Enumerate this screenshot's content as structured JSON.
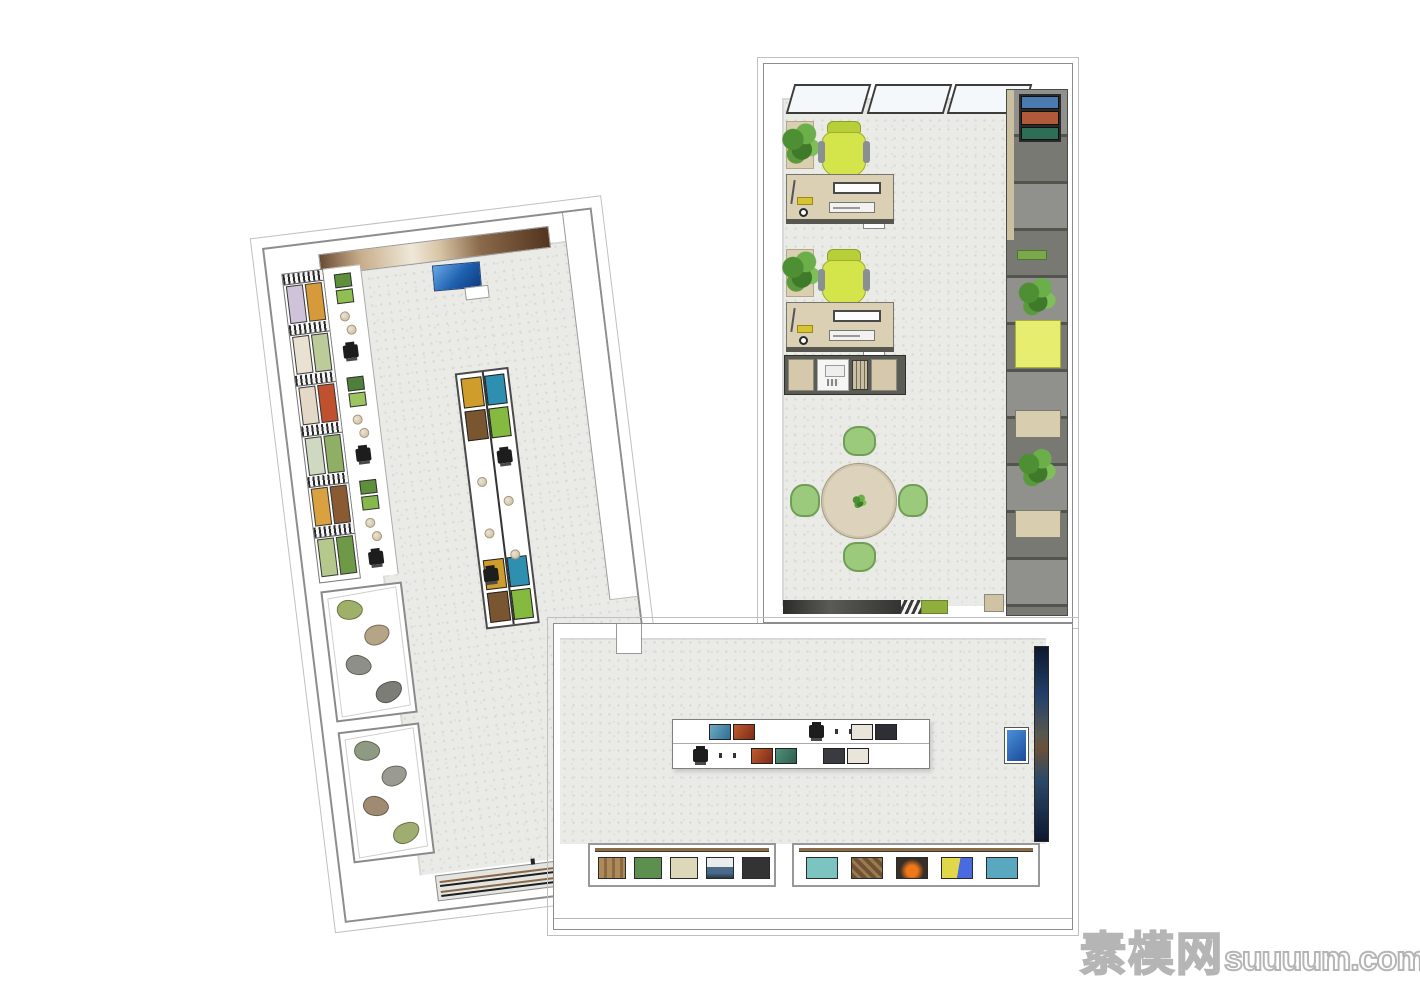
{
  "scene": {
    "type": "3D top-view floor plan render of an L-shaped exhibition hall with office",
    "background": "#ffffff",
    "floor_color": "#eaeae7",
    "wall_color": "#ffffff",
    "outline_color": "#8d8d8d"
  },
  "watermark": {
    "cn": "素模网",
    "en": "suuuum.com",
    "color": "#b5b5b5"
  },
  "left_gallery": {
    "mural_style": "background:linear-gradient(90deg,#6b4c33,#c9ae8b 18%,#efe8d9 40%,#d9c5a6 52%,#8a6a4a 70%,#53341f)",
    "tv_style": "background:linear-gradient(135deg,#66a8e4,#1e5fae 55%,#0f3c7e)",
    "wall_art_pairs": [
      {
        "a": "#cfc3da",
        "b": "#d79a3b"
      },
      {
        "a": "#e9e2d2",
        "b": "#bccb9a"
      },
      {
        "a": "#e3d9c6",
        "b": "#c0512f"
      },
      {
        "a": "#cfd8c0",
        "b": "#8fae66"
      },
      {
        "a": "#d9a13f",
        "b": "#8a5a33"
      },
      {
        "a": "#b5c98c",
        "b": "#6e9a48"
      }
    ],
    "counter_groups": [
      {
        "a": "#5e8f3a",
        "b": "#8fbf52"
      },
      {
        "a": "#4f7f3a",
        "b": "#9cc561"
      },
      {
        "a": "#5e8f3a",
        "b": "#86b84e"
      }
    ],
    "island": {
      "top_panels": [
        "#cf9d2b",
        "#2e8fb0",
        "#7a5630",
        "#85b93f"
      ],
      "bottom_panels": [
        "#cf9d2b",
        "#2e8fb0",
        "#7a5630",
        "#85b93f"
      ]
    },
    "mineral_case_upper": {
      "specimens": [
        "#9fb169",
        "#b5a486",
        "#8f8f89",
        "#7d7d77"
      ]
    },
    "mineral_case_lower": {
      "specimens": [
        "#8f9a82",
        "#9a9a93",
        "#a08a72",
        "#9fae70"
      ]
    }
  },
  "office": {
    "workstation_count": 2,
    "desk_style": "background:#dbcfb4",
    "chair_style": "background:#d3e54a",
    "meeting_table_style": "background:#ddd2bb",
    "meeting_chair_style": "background:#9bca7c",
    "meeting_seat_count": 4,
    "shelf": {
      "magazine_colors": [
        "#4a7ab0",
        "#b05a3a",
        "#2f6e56"
      ],
      "yellow_box_style": "background:#e7ee6f"
    },
    "entry_mat_style": "background:linear-gradient(90deg,#2c2c2a,#5a5a56 40%,#333331)",
    "green_mat_style": "background:#8fae3d"
  },
  "bottom_gallery": {
    "display_wall": {
      "back_pictures": [
        "linear-gradient(120deg,#6fa9c5,#2f6f93)",
        "linear-gradient(120deg,#c05a2e,#7e2b16)",
        "#e9e5da",
        "#2e2e35"
      ],
      "front_pictures": [
        "linear-gradient(120deg,#c05a2e,#7e2b16)",
        "linear-gradient(120deg,#4e8f7a,#2e5f4e)",
        "#3a3a41",
        "#e9e5da"
      ]
    },
    "blue_artwork_style": "background:linear-gradient(180deg,#0d1830,#23406a 25%,#57584f 45%,#6a5138 52%,#2c4a68 68%,#0d1830)",
    "wall_screen_style": "background:linear-gradient(135deg,#4a90d8,#1a4a9a)",
    "pit_a_artworks": [
      "repeating-linear-gradient(90deg,#b0895a 0 5px,#8a6a42 5px 8px)",
      "#5d8f4e",
      "#ded8bb",
      "linear-gradient(180deg,#e9eced 0 45%,#4a6a8a 45% 75%,#26394a)",
      "#333333"
    ],
    "pit_b_artworks": [
      "#7cc4c0",
      "repeating-linear-gradient(45deg,#6e5233 0 4px,#9a7a4e 4px 7px)",
      "radial-gradient(circle at 50% 65%,#f07818 0 28%,#3a2f28 60%)",
      "linear-gradient(100deg,#e0d84a 0 55%,#4a6ae0 55%)",
      "#5aa8c0"
    ]
  }
}
